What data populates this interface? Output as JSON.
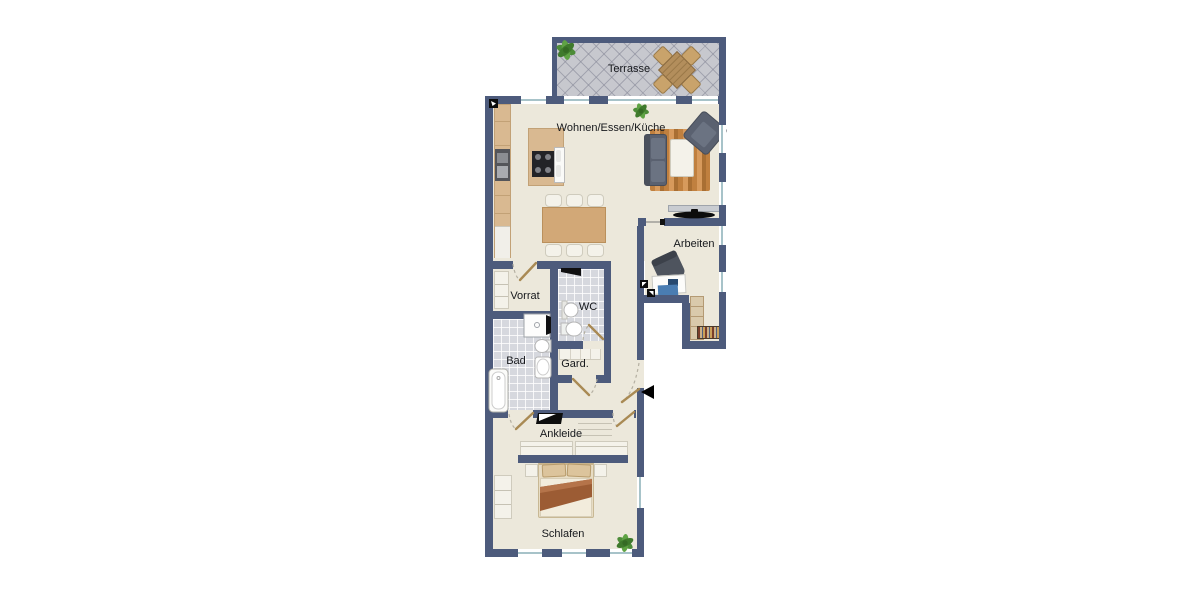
{
  "image_type": "apartment-floor-plan",
  "rooms": {
    "terrasse": {
      "label": "Terrasse"
    },
    "wohnen": {
      "label": "Wohnen/Essen/Küche"
    },
    "arbeiten": {
      "label": "Arbeiten"
    },
    "vorrat": {
      "label": "Vorrat"
    },
    "wc": {
      "label": "WC"
    },
    "bad": {
      "label": "Bad"
    },
    "gard": {
      "label": "Gard."
    },
    "ankleide": {
      "label": "Ankleide"
    },
    "schlafen": {
      "label": "Schlafen"
    }
  },
  "colors": {
    "wall": "#4d5b7c",
    "floor": "#ece8db",
    "bath_tile": "#d6d8de",
    "terrace_tile": "#c7c8ce",
    "window_glass": "#a7c3c9",
    "wood": "#d2a877",
    "kitchen_cabinet": "#d9b991",
    "upholstery": "#5a6170",
    "door_leaf": "#a98a54",
    "plant_green": "#4d8c38",
    "bed_blanket_stripe": "#9c5c34"
  },
  "icons": {
    "entrance_arrow": "◀"
  }
}
